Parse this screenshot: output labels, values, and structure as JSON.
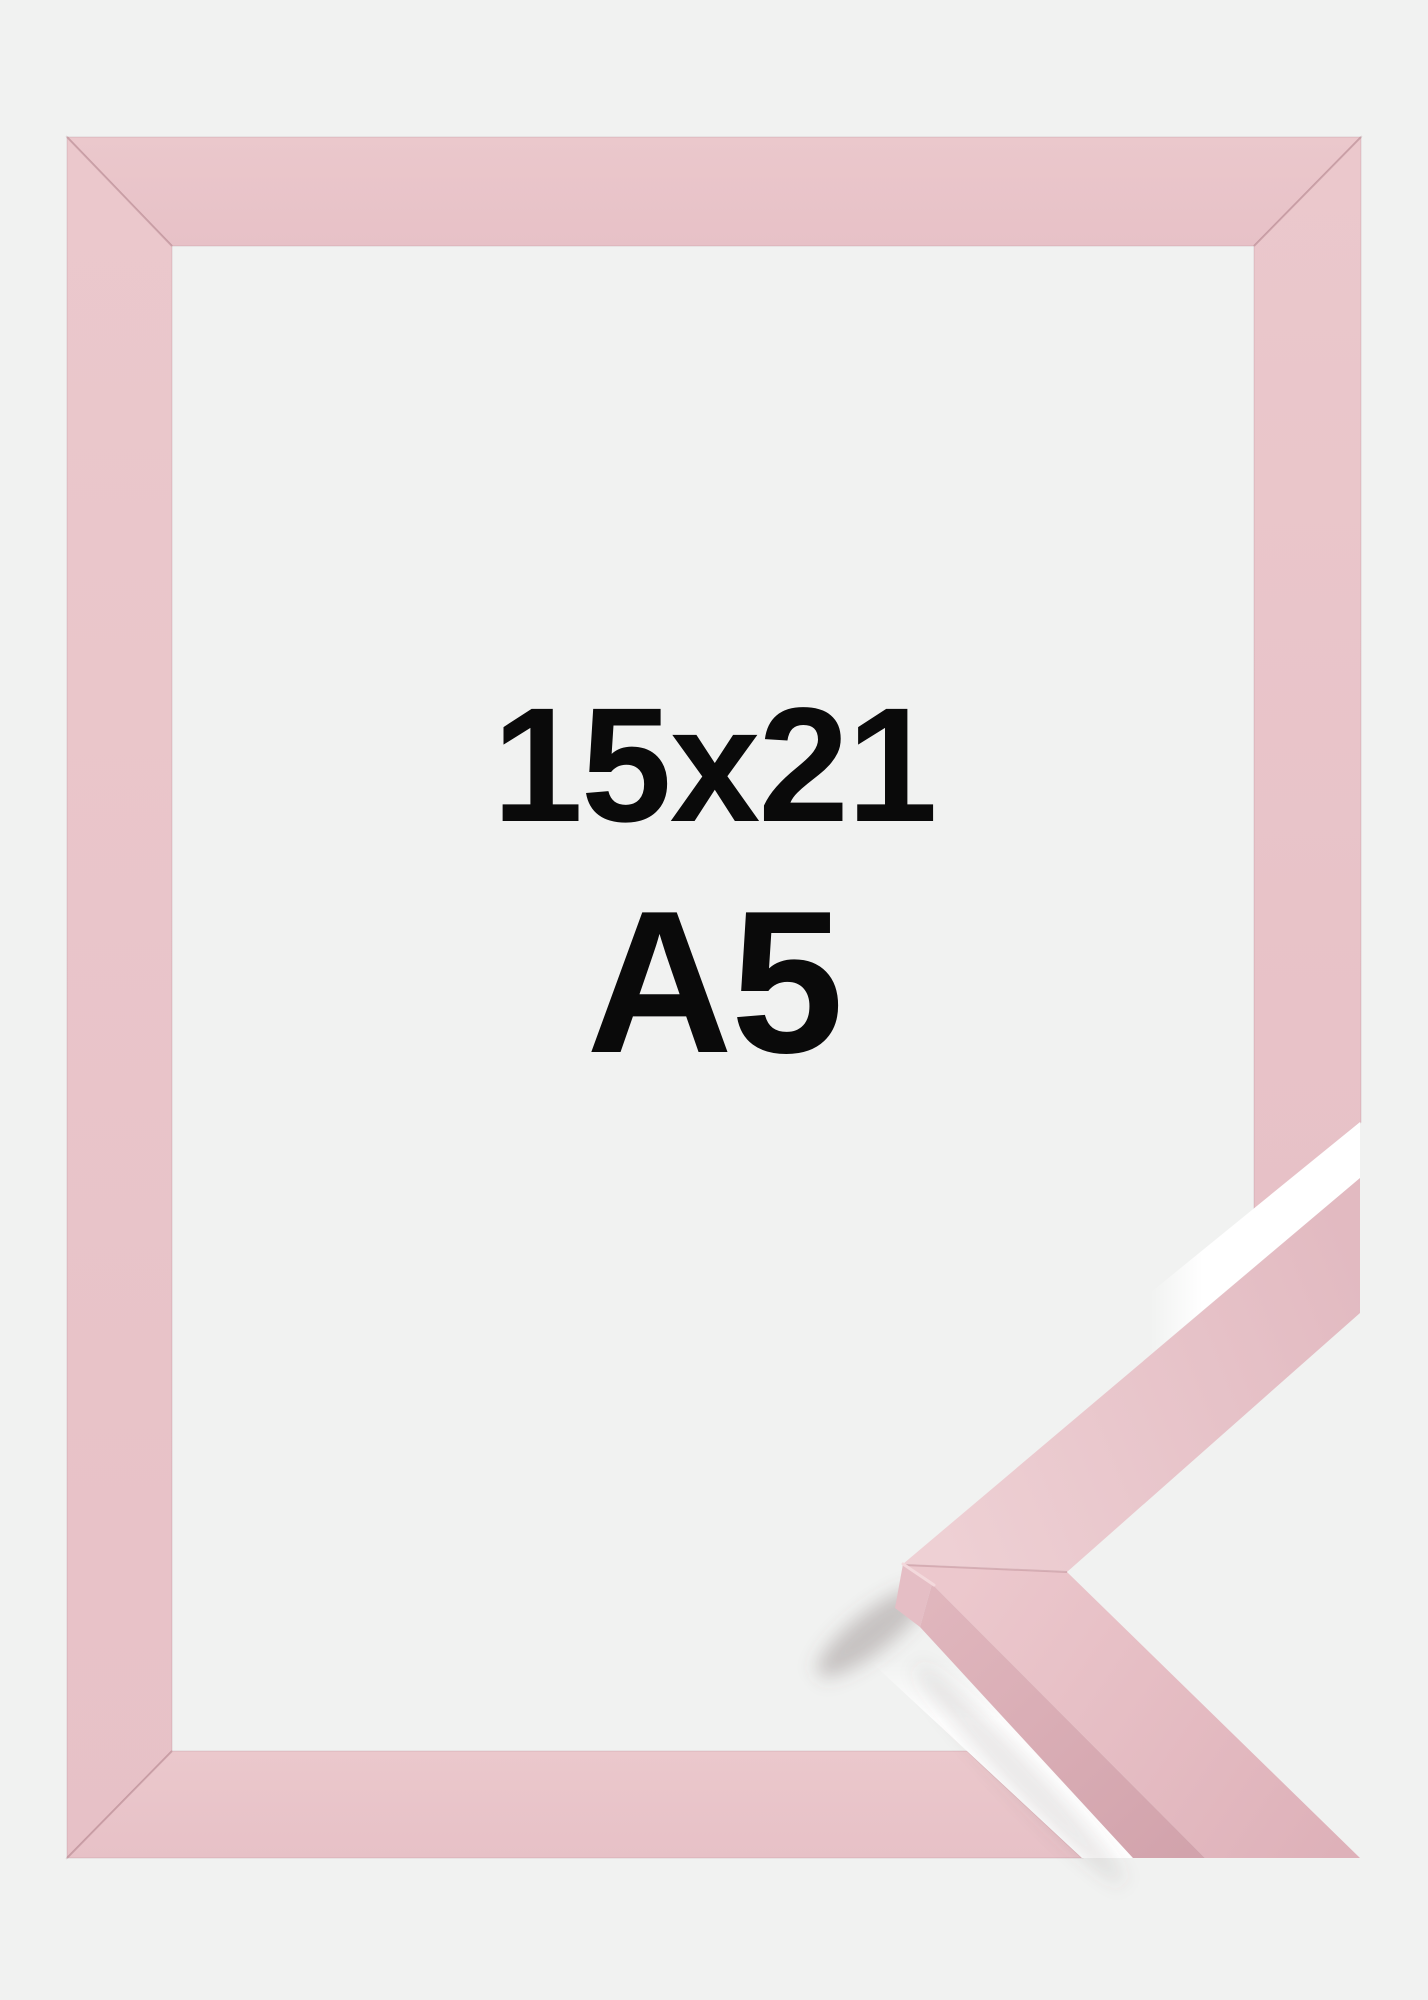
{
  "product_photo": {
    "size_label": "15x21",
    "format_label": "A5",
    "colors": {
      "background": "#f1f2f1",
      "text": "#0a0a0a",
      "pink_light": "#ebc8cc",
      "pink_shade": "#e7c1c7",
      "arm_light": "#eed0d4",
      "arm_dark": "#e2bac1",
      "lower_arm_light": "#ecc8cd",
      "lower_arm_dark": "#deb1b9",
      "side_face_light": "#e0b6bd",
      "side_face_dark": "#d2a3ac",
      "end_cap": "#e5bec5",
      "cap_highlight": "#f3d9dc",
      "miter_seam": "rgba(160,105,115,0.30)",
      "gap_white": "#ffffff",
      "shadow_soft": "rgba(98,82,85,0.30)",
      "shadow_faint": "rgba(98,82,85,0.13)"
    }
  }
}
